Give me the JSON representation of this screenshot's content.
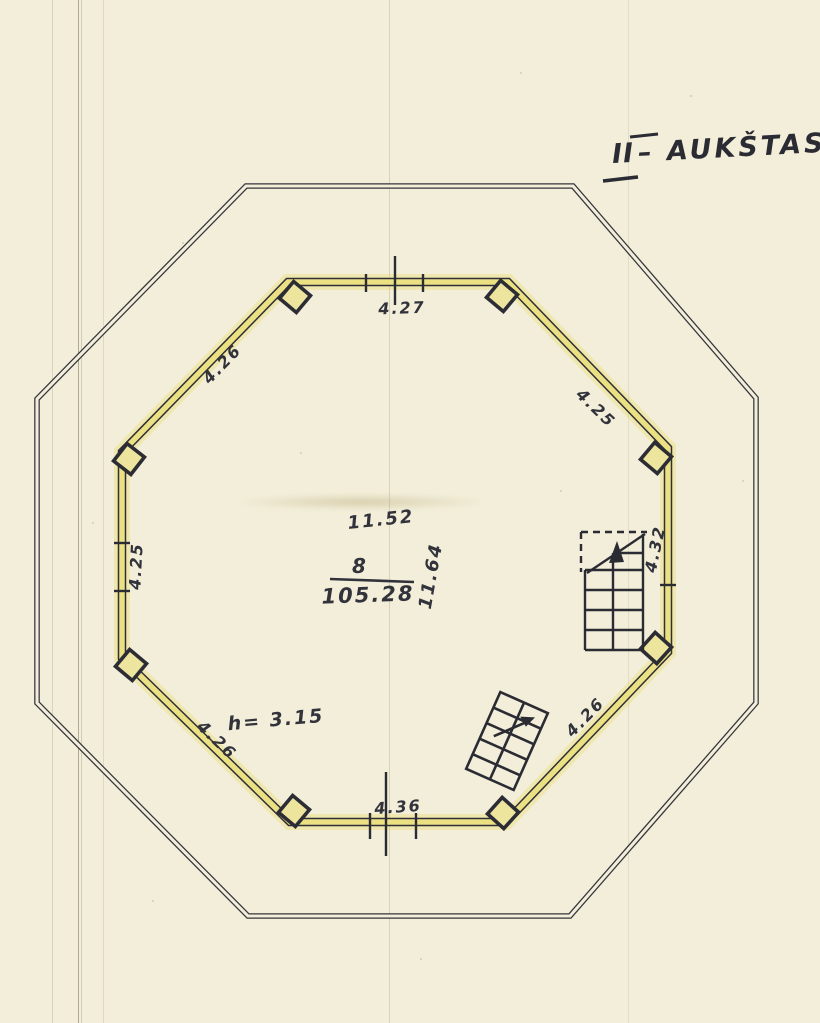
{
  "drawing": {
    "kind": "octagonal floor plan, scanned hand drawing",
    "paper_color": "#f2eed9",
    "ink_color": "#2e2e36",
    "wall_highlight_color": "#ebe183",
    "column_fill_color": "#ede59e"
  },
  "title": {
    "numeral": "II",
    "name": "– AUKŠTAS"
  },
  "dimensions": {
    "top": "4.27",
    "top_left": "4.26",
    "top_right": "4.25",
    "left": "4.25",
    "right": "4.32",
    "bottom_left": "4.26",
    "bottom": "4.36",
    "bottom_right_by_stair": "4.26"
  },
  "room": {
    "number": "8",
    "area": "105.28",
    "width": "11.52",
    "depth": "11.64",
    "ceiling_height": "h= 3.15"
  }
}
